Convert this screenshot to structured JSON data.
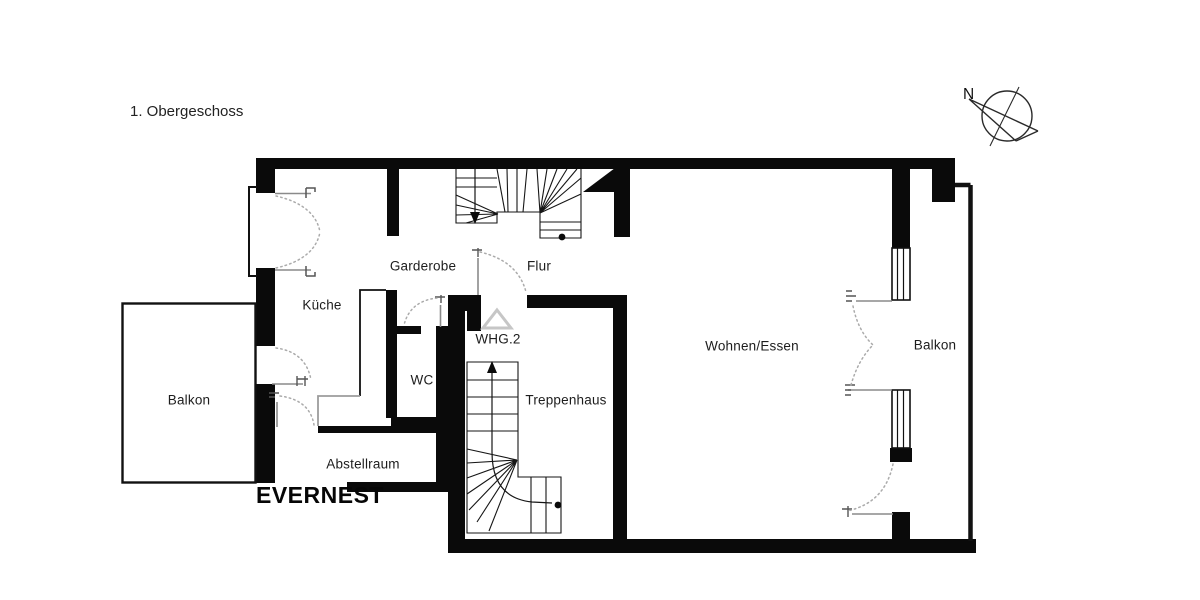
{
  "title": "1. Obergeschoss",
  "brand": "EVERNEST",
  "compass": {
    "north_label": "N"
  },
  "rooms": {
    "kueche": "Küche",
    "garderobe": "Garderobe",
    "flur": "Flur",
    "whg2": "WHG.2",
    "wc": "WC",
    "treppenhaus": "Treppenhaus",
    "abstellraum": "Abstellraum",
    "wohnen_essen": "Wohnen/Essen",
    "balkon_links": "Balkon",
    "balkon_rechts": "Balkon"
  },
  "colors": {
    "wall": "#0a0a0a",
    "background": "#ffffff",
    "door_arc": "#ababab",
    "door_leaf": "#8a8a8a",
    "marker_gray": "#c6c6c6"
  }
}
